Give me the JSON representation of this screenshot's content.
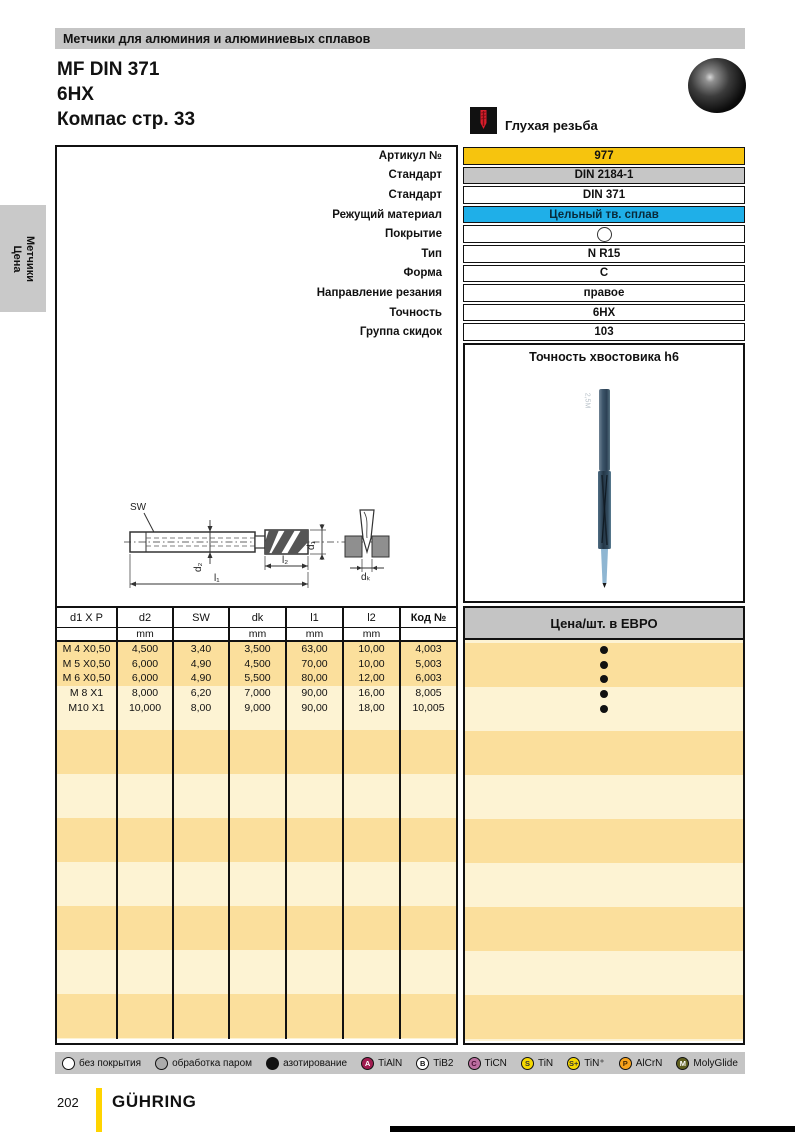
{
  "page": {
    "category_header": "Метчики для алюминия и алюминиевых сплавов",
    "title_line1": "MF DIN 371",
    "title_line2": "6HX",
    "title_line3": "Компас стр. 33",
    "thread_type_label": "Глухая резьба",
    "side_tab_line1": "Метчики",
    "side_tab_line2": "Цена",
    "page_number": "202",
    "brand": "GÜHRING"
  },
  "specs": {
    "rows": [
      {
        "label": "Артикул №",
        "value": "977"
      },
      {
        "label": "Стандарт",
        "value": "DIN 2184-1"
      },
      {
        "label": "Стандарт",
        "value": "DIN 371"
      },
      {
        "label": "Режущий материал",
        "value": "Цельный тв. сплав"
      },
      {
        "label": "Покрытие",
        "value": ""
      },
      {
        "label": "Тип",
        "value": "N R15"
      },
      {
        "label": "Форма",
        "value": "C"
      },
      {
        "label": "Направление резания",
        "value": "правое"
      },
      {
        "label": "Точность",
        "value": "6HX"
      },
      {
        "label": "Группа скидок",
        "value": "103"
      }
    ],
    "shank_note": "Точность хвостовика h6"
  },
  "drawing": {
    "labels": {
      "sw": "SW",
      "d2": "d₂",
      "l2": "l₂",
      "l1": "l₁",
      "d1": "d₁",
      "dk": "dₖ"
    }
  },
  "table": {
    "columns": [
      "d1 X P",
      "d2",
      "SW",
      "dk",
      "l1",
      "l2",
      "Код №"
    ],
    "units": [
      "",
      "mm",
      "",
      "mm",
      "mm",
      "mm",
      ""
    ],
    "rows": [
      [
        "M 4 X0,50",
        "4,500",
        "3,40",
        "3,500",
        "63,00",
        "10,00",
        "4,003"
      ],
      [
        "M 5 X0,50",
        "6,000",
        "4,90",
        "4,500",
        "70,00",
        "10,00",
        "5,003"
      ],
      [
        "M 6 X0,50",
        "6,000",
        "4,90",
        "5,500",
        "80,00",
        "12,00",
        "6,003"
      ],
      [
        "M 8 X1",
        "8,000",
        "6,20",
        "7,000",
        "90,00",
        "16,00",
        "8,005"
      ],
      [
        "M10 X1",
        "10,000",
        "8,00",
        "9,000",
        "90,00",
        "18,00",
        "10,005"
      ]
    ]
  },
  "price": {
    "header": "Цена/шт. в ЕВРО",
    "dot_count": 5
  },
  "legend": {
    "items": [
      {
        "badge": "",
        "label": "без покрытия"
      },
      {
        "badge": "",
        "label": "обработка паром"
      },
      {
        "badge": "",
        "label": "азотирование"
      },
      {
        "badge": "A",
        "label": "TiAlN"
      },
      {
        "badge": "B",
        "label": "TiB2"
      },
      {
        "badge": "C",
        "label": "TiCN"
      },
      {
        "badge": "S",
        "label": "TiN"
      },
      {
        "badge": "S+",
        "label": "TiN⁺"
      },
      {
        "badge": "P",
        "label": "AlCrN"
      },
      {
        "badge": "M",
        "label": "MolyGlide"
      }
    ]
  },
  "colors": {
    "header_bar": "#c5c5c5",
    "article_yellow": "#f6c40e",
    "standard_gray": "#c6c6c6",
    "carbide_cyan": "#1fafe8",
    "band_dark": "#fbdf9c",
    "band_light": "#fdf3d3",
    "brand_yellow": "#ffd400",
    "badge_tialn": "#a01c50",
    "badge_ticn": "#bc6ea0",
    "badge_tin": "#f5d800",
    "badge_alcrn": "#f6a21c",
    "badge_molyglide": "#5e5e1e"
  }
}
